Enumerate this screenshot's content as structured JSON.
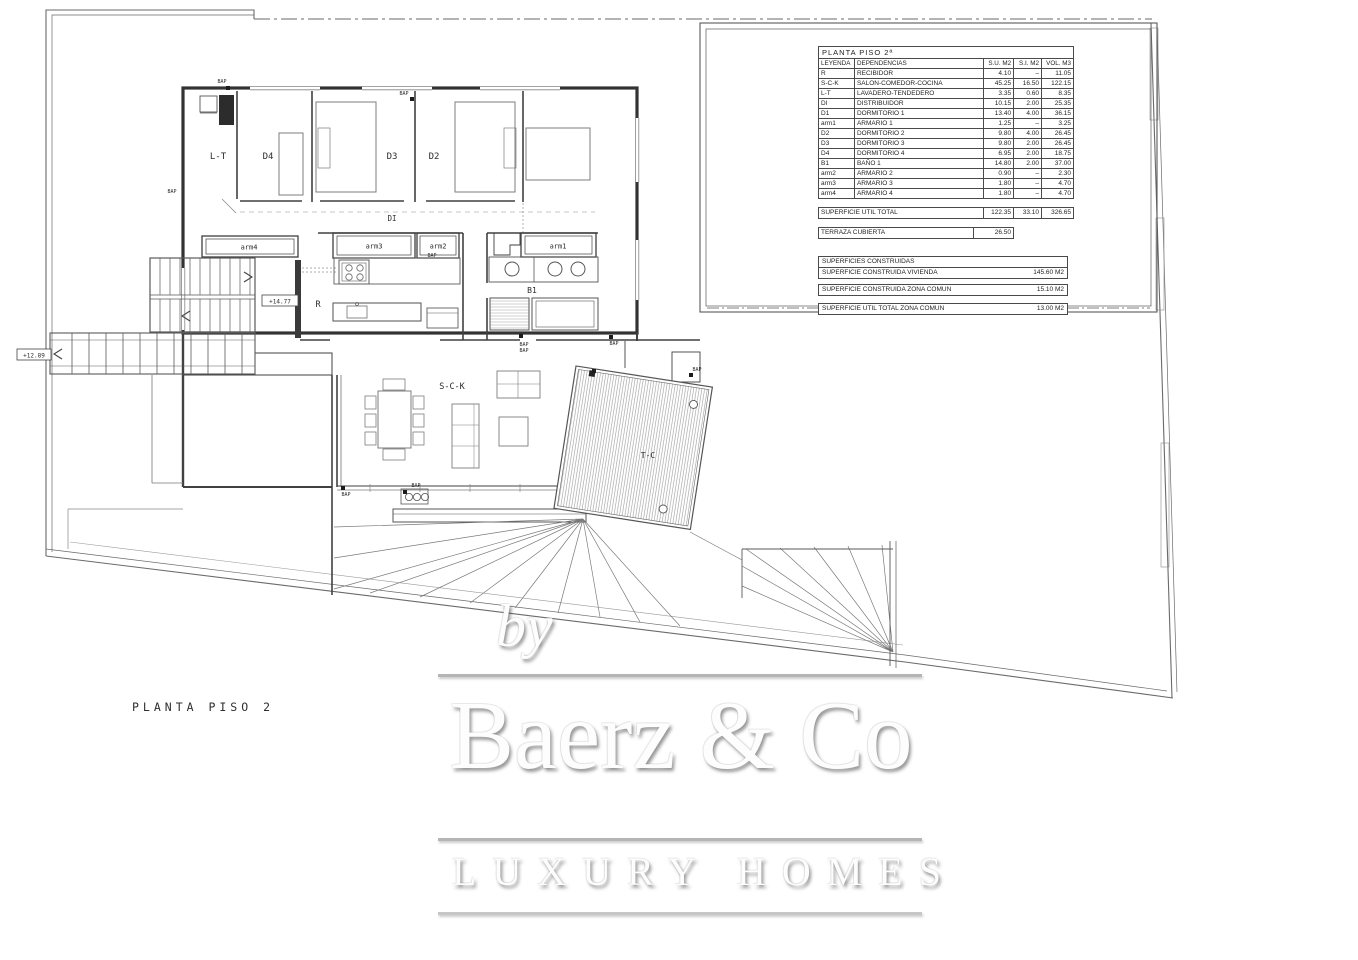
{
  "drawing_title": "PLANTA PISO 2",
  "plan": {
    "rooms": {
      "lt": "L-T",
      "d4": "D4",
      "d3": "D3",
      "d2": "D2",
      "di": "DI",
      "arm4": "arm4",
      "arm3": "arm3",
      "arm2": "arm2",
      "arm1": "arm1",
      "b1": "B1",
      "r": "R",
      "sck": "S-C-K",
      "tc": "T-C"
    },
    "levels": {
      "upper": "+14.77",
      "lower": "+12.89"
    },
    "vent_label": "BAP"
  },
  "legend": {
    "title": "PLANTA PISO 2ª",
    "headers": [
      "LEYENDA",
      "DEPENDENCIAS",
      "S.U. M2",
      "S.I. M2",
      "VOL. M3"
    ],
    "rows": [
      [
        "R",
        "RECIBIDOR",
        "4.10",
        "–",
        "11.05"
      ],
      [
        "S-C-K",
        "SALON-COMEDOR-COCINA",
        "45.25",
        "16.50",
        "122.15"
      ],
      [
        "L-T",
        "LAVADERO-TENDEDERO",
        "3.35",
        "0.60",
        "8.35"
      ],
      [
        "DI",
        "DISTRIBUIDOR",
        "10.15",
        "2.00",
        "25.35"
      ],
      [
        "D1",
        "DORMITORIO 1",
        "13.40",
        "4.00",
        "36.15"
      ],
      [
        "arm1",
        "ARMARIO 1",
        "1.25",
        "–",
        "3.25"
      ],
      [
        "D2",
        "DORMITORIO 2",
        "9.80",
        "4.00",
        "26.45"
      ],
      [
        "D3",
        "DORMITORIO 3",
        "9.80",
        "2.00",
        "26.45"
      ],
      [
        "D4",
        "DORMITORIO 4",
        "6.95",
        "2.00",
        "18.75"
      ],
      [
        "B1",
        "BAÑO 1",
        "14.80",
        "2.00",
        "37.00"
      ],
      [
        "arm2",
        "ARMARIO 2",
        "0.90",
        "–",
        "2.30"
      ],
      [
        "arm3",
        "ARMARIO 3",
        "1.80",
        "–",
        "4.70"
      ],
      [
        "arm4",
        "ARMARIO 4",
        "1.80",
        "–",
        "4.70"
      ]
    ]
  },
  "totals": {
    "util_total": {
      "label": "SUPERFICIE UTIL TOTAL",
      "su": "122.35",
      "si": "33.10",
      "vol": "326.65"
    },
    "terraza": {
      "label": "TERRAZA CUBIERTA",
      "value": "26.50"
    },
    "construidas_header": "SUPERFICIES CONSTRUIDAS",
    "vivienda": {
      "label": "SUPERFICIE CONSTRUIDA VIVIENDA",
      "value": "145.60 M2"
    },
    "zona_comun": {
      "label": "SUPERFICIE CONSTRUIDA ZONA COMUN",
      "value": "15.10 M2"
    },
    "util_zona_comun": {
      "label": "SUPERFICIE UTIL TOTAL ZONA COMUN",
      "value": "13.00 M2"
    }
  },
  "watermark": {
    "prefix": "by",
    "brand": "Baerz & Co",
    "tagline": "LUXURY HOMES"
  }
}
